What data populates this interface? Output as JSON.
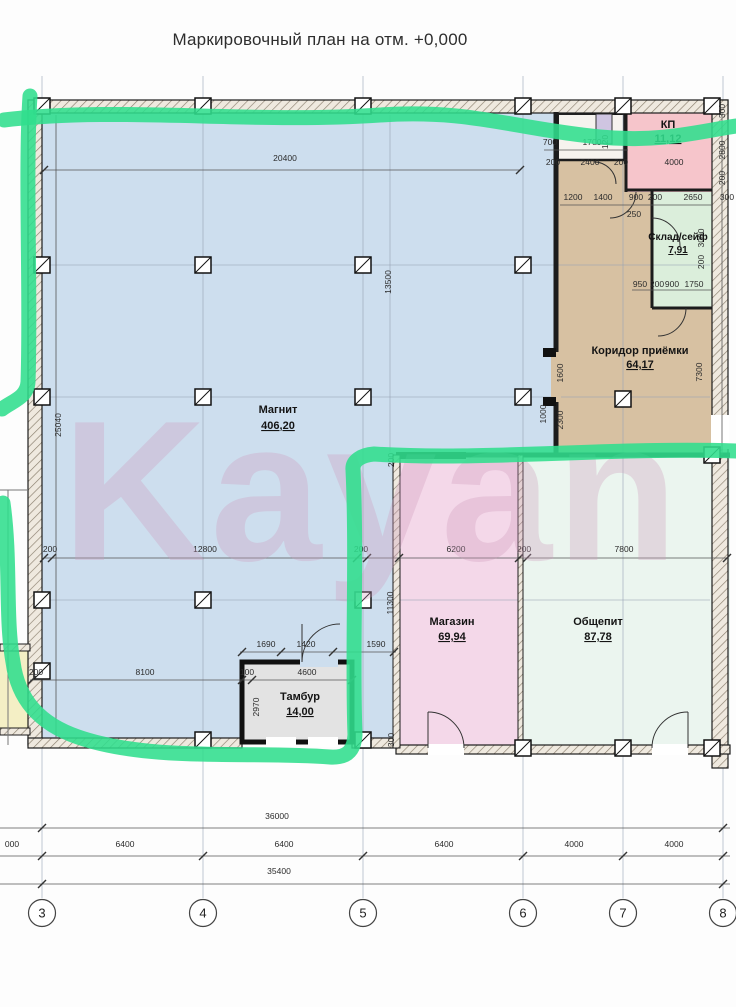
{
  "title": "Маркировочный план на отм. +0,000",
  "watermark": "Kayan",
  "rooms": {
    "magnit": {
      "name": "Магнит",
      "area": "406,20"
    },
    "kp": {
      "name": "КП",
      "area": "11,12"
    },
    "sklad": {
      "name": "Склад/сейф",
      "area": "7,91"
    },
    "koridor": {
      "name": "Коридор приёмки",
      "area": "64,17"
    },
    "magazin": {
      "name": "Магазин",
      "area": "69,94"
    },
    "obshepit": {
      "name": "Общепит",
      "area": "87,78"
    },
    "tambur": {
      "name": "Тамбур",
      "area": "14,00"
    }
  },
  "axes": [
    {
      "label": "3",
      "x": 42
    },
    {
      "label": "4",
      "x": 203
    },
    {
      "label": "5",
      "x": 363
    },
    {
      "label": "6",
      "x": 523
    },
    {
      "label": "7",
      "x": 623
    },
    {
      "label": "8",
      "x": 723
    }
  ],
  "dimensions": [
    {
      "text": "20400",
      "x": 285,
      "y": 161,
      "rot": 0
    },
    {
      "text": "13500",
      "x": 391,
      "y": 282,
      "rot": 90
    },
    {
      "text": "25040",
      "x": 61,
      "y": 425,
      "rot": 90
    },
    {
      "text": "200",
      "x": 50,
      "y": 552,
      "rot": 0
    },
    {
      "text": "12800",
      "x": 205,
      "y": 552,
      "rot": 0
    },
    {
      "text": "200",
      "x": 361,
      "y": 552,
      "rot": 0
    },
    {
      "text": "6200",
      "x": 456,
      "y": 552,
      "rot": 0
    },
    {
      "text": "200",
      "x": 524,
      "y": 552,
      "rot": 0
    },
    {
      "text": "7800",
      "x": 624,
      "y": 552,
      "rot": 0
    },
    {
      "text": "200",
      "x": 394,
      "y": 460,
      "rot": 90
    },
    {
      "text": "11300",
      "x": 393,
      "y": 603,
      "rot": 90
    },
    {
      "text": "1690",
      "x": 266,
      "y": 647,
      "rot": 0
    },
    {
      "text": "1420",
      "x": 306,
      "y": 647,
      "rot": 0
    },
    {
      "text": "1590",
      "x": 376,
      "y": 647,
      "rot": 0
    },
    {
      "text": "200",
      "x": 36,
      "y": 675,
      "rot": 0
    },
    {
      "text": "8100",
      "x": 145,
      "y": 675,
      "rot": 0
    },
    {
      "text": "100",
      "x": 247,
      "y": 675,
      "rot": 0
    },
    {
      "text": "4600",
      "x": 307,
      "y": 675,
      "rot": 0
    },
    {
      "text": "2970",
      "x": 259,
      "y": 707,
      "rot": 90
    },
    {
      "text": "300",
      "x": 394,
      "y": 740,
      "rot": 90
    },
    {
      "text": "700",
      "x": 550,
      "y": 145,
      "rot": 0
    },
    {
      "text": "1700",
      "x": 592,
      "y": 145,
      "rot": 0
    },
    {
      "text": "120",
      "x": 608,
      "y": 142,
      "rot": 90
    },
    {
      "text": "200",
      "x": 553,
      "y": 165,
      "rot": 0
    },
    {
      "text": "2400",
      "x": 590,
      "y": 165,
      "rot": 0
    },
    {
      "text": "200",
      "x": 621,
      "y": 165,
      "rot": 0
    },
    {
      "text": "4000",
      "x": 674,
      "y": 165,
      "rot": 0
    },
    {
      "text": "1200",
      "x": 573,
      "y": 200,
      "rot": 0
    },
    {
      "text": "1400",
      "x": 603,
      "y": 200,
      "rot": 0
    },
    {
      "text": "900",
      "x": 636,
      "y": 200,
      "rot": 0
    },
    {
      "text": "200",
      "x": 655,
      "y": 200,
      "rot": 0
    },
    {
      "text": "2650",
      "x": 693,
      "y": 200,
      "rot": 0
    },
    {
      "text": "300",
      "x": 727,
      "y": 200,
      "rot": 0
    },
    {
      "text": "250",
      "x": 634,
      "y": 217,
      "rot": 0
    },
    {
      "text": "300",
      "x": 725,
      "y": 111,
      "rot": 90
    },
    {
      "text": "2800",
      "x": 725,
      "y": 150,
      "rot": 90
    },
    {
      "text": "200",
      "x": 725,
      "y": 178,
      "rot": 90
    },
    {
      "text": "3000",
      "x": 704,
      "y": 238,
      "rot": 90
    },
    {
      "text": "200",
      "x": 704,
      "y": 262,
      "rot": 90
    },
    {
      "text": "950",
      "x": 640,
      "y": 287,
      "rot": 0
    },
    {
      "text": "200",
      "x": 657,
      "y": 287,
      "rot": 0
    },
    {
      "text": "900",
      "x": 672,
      "y": 287,
      "rot": 0
    },
    {
      "text": "1750",
      "x": 694,
      "y": 287,
      "rot": 0
    },
    {
      "text": "7300",
      "x": 702,
      "y": 372,
      "rot": 90
    },
    {
      "text": "1600",
      "x": 563,
      "y": 373,
      "rot": 90
    },
    {
      "text": "2300",
      "x": 563,
      "y": 420,
      "rot": 90
    },
    {
      "text": "1000",
      "x": 546,
      "y": 414,
      "rot": 90
    },
    {
      "text": "36000",
      "x": 277,
      "y": 819,
      "rot": 0
    },
    {
      "text": "000",
      "x": 12,
      "y": 847,
      "rot": 0
    },
    {
      "text": "6400",
      "x": 125,
      "y": 847,
      "rot": 0
    },
    {
      "text": "6400",
      "x": 284,
      "y": 847,
      "rot": 0
    },
    {
      "text": "6400",
      "x": 444,
      "y": 847,
      "rot": 0
    },
    {
      "text": "4000",
      "x": 574,
      "y": 847,
      "rot": 0
    },
    {
      "text": "4000",
      "x": 674,
      "y": 847,
      "rot": 0
    },
    {
      "text": "35400",
      "x": 279,
      "y": 874,
      "rot": 0
    }
  ],
  "colors": {
    "magnit": "#cddeee",
    "kp": "#f6c5cb",
    "sklad": "#dbeedb",
    "koridor": "#d7c1a2",
    "magazin": "#f4d8e9",
    "obshepit": "#ebf5ef",
    "tambur": "#e3e3e3",
    "yellow_room": "#f4efc5",
    "marker_green": "#30de8d",
    "watermark_pink": "#cf9dbd"
  }
}
